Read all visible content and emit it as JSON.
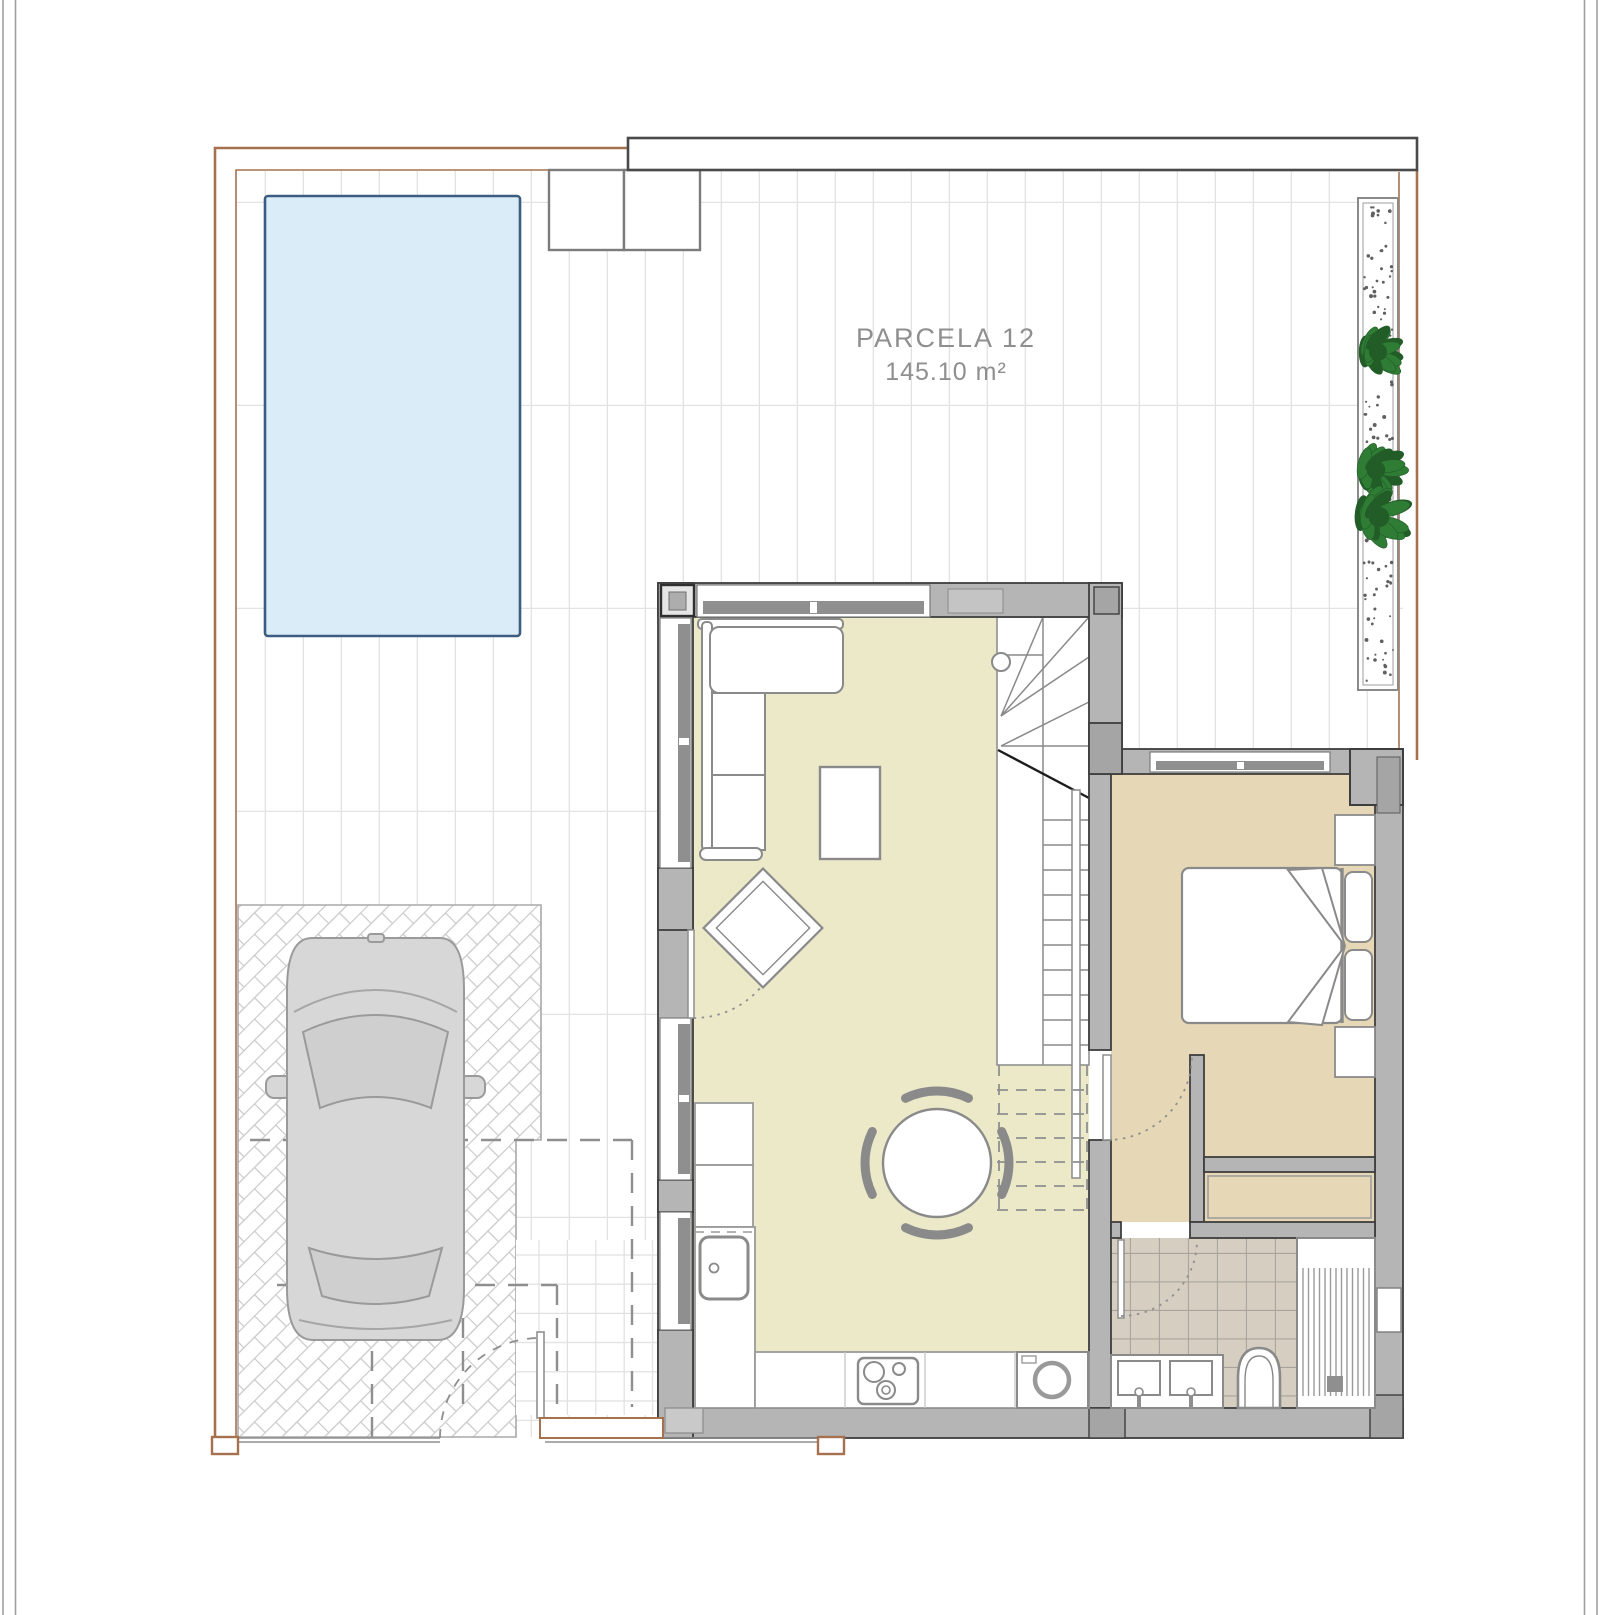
{
  "plan": {
    "parcel_name": "PARCELA 12",
    "parcel_area": "145.10 m²"
  },
  "colors": {
    "page_frame": "#9f9f9f",
    "boundary_brown": "#a5714f",
    "tile_line": "#e3e3e3",
    "small_tile_line": "#e0e0e0",
    "herringbone_line": "#c9c9c9",
    "pool_fill": "#d9ecf8",
    "pool_border": "#3c5d80",
    "wall_fill": "#b5b5b5",
    "wall_stroke": "#3e3e3e",
    "glazing_gray": "#8f8f8f",
    "living_floor": "#ebe9c8",
    "bedroom_floor": "#e6d8b7",
    "bath_tile_fill": "#d6cec1",
    "bath_tile_line": "#a8a49b",
    "furniture_stroke": "#8a8a8a",
    "car_fill": "#d7d7d7",
    "car_glass": "#cfcfcf",
    "car_stroke": "#9a9a9a",
    "plant_green": "#2f7c35",
    "plant_dark": "#225c27",
    "stipple_dot": "#606060",
    "label_text": "#8f8f8f",
    "dashed_mark": "#8f8f8f"
  },
  "decor": {
    "stipple_area": {
      "x1": 1363,
      "y1": 205,
      "x2": 1393,
      "y2": 683,
      "count": 120
    },
    "plants": [
      {
        "cx": 1378,
        "cy": 352,
        "r": 30
      },
      {
        "cx": 1376,
        "cy": 470,
        "r": 31
      },
      {
        "cx": 1379,
        "cy": 517,
        "r": 34
      }
    ]
  }
}
